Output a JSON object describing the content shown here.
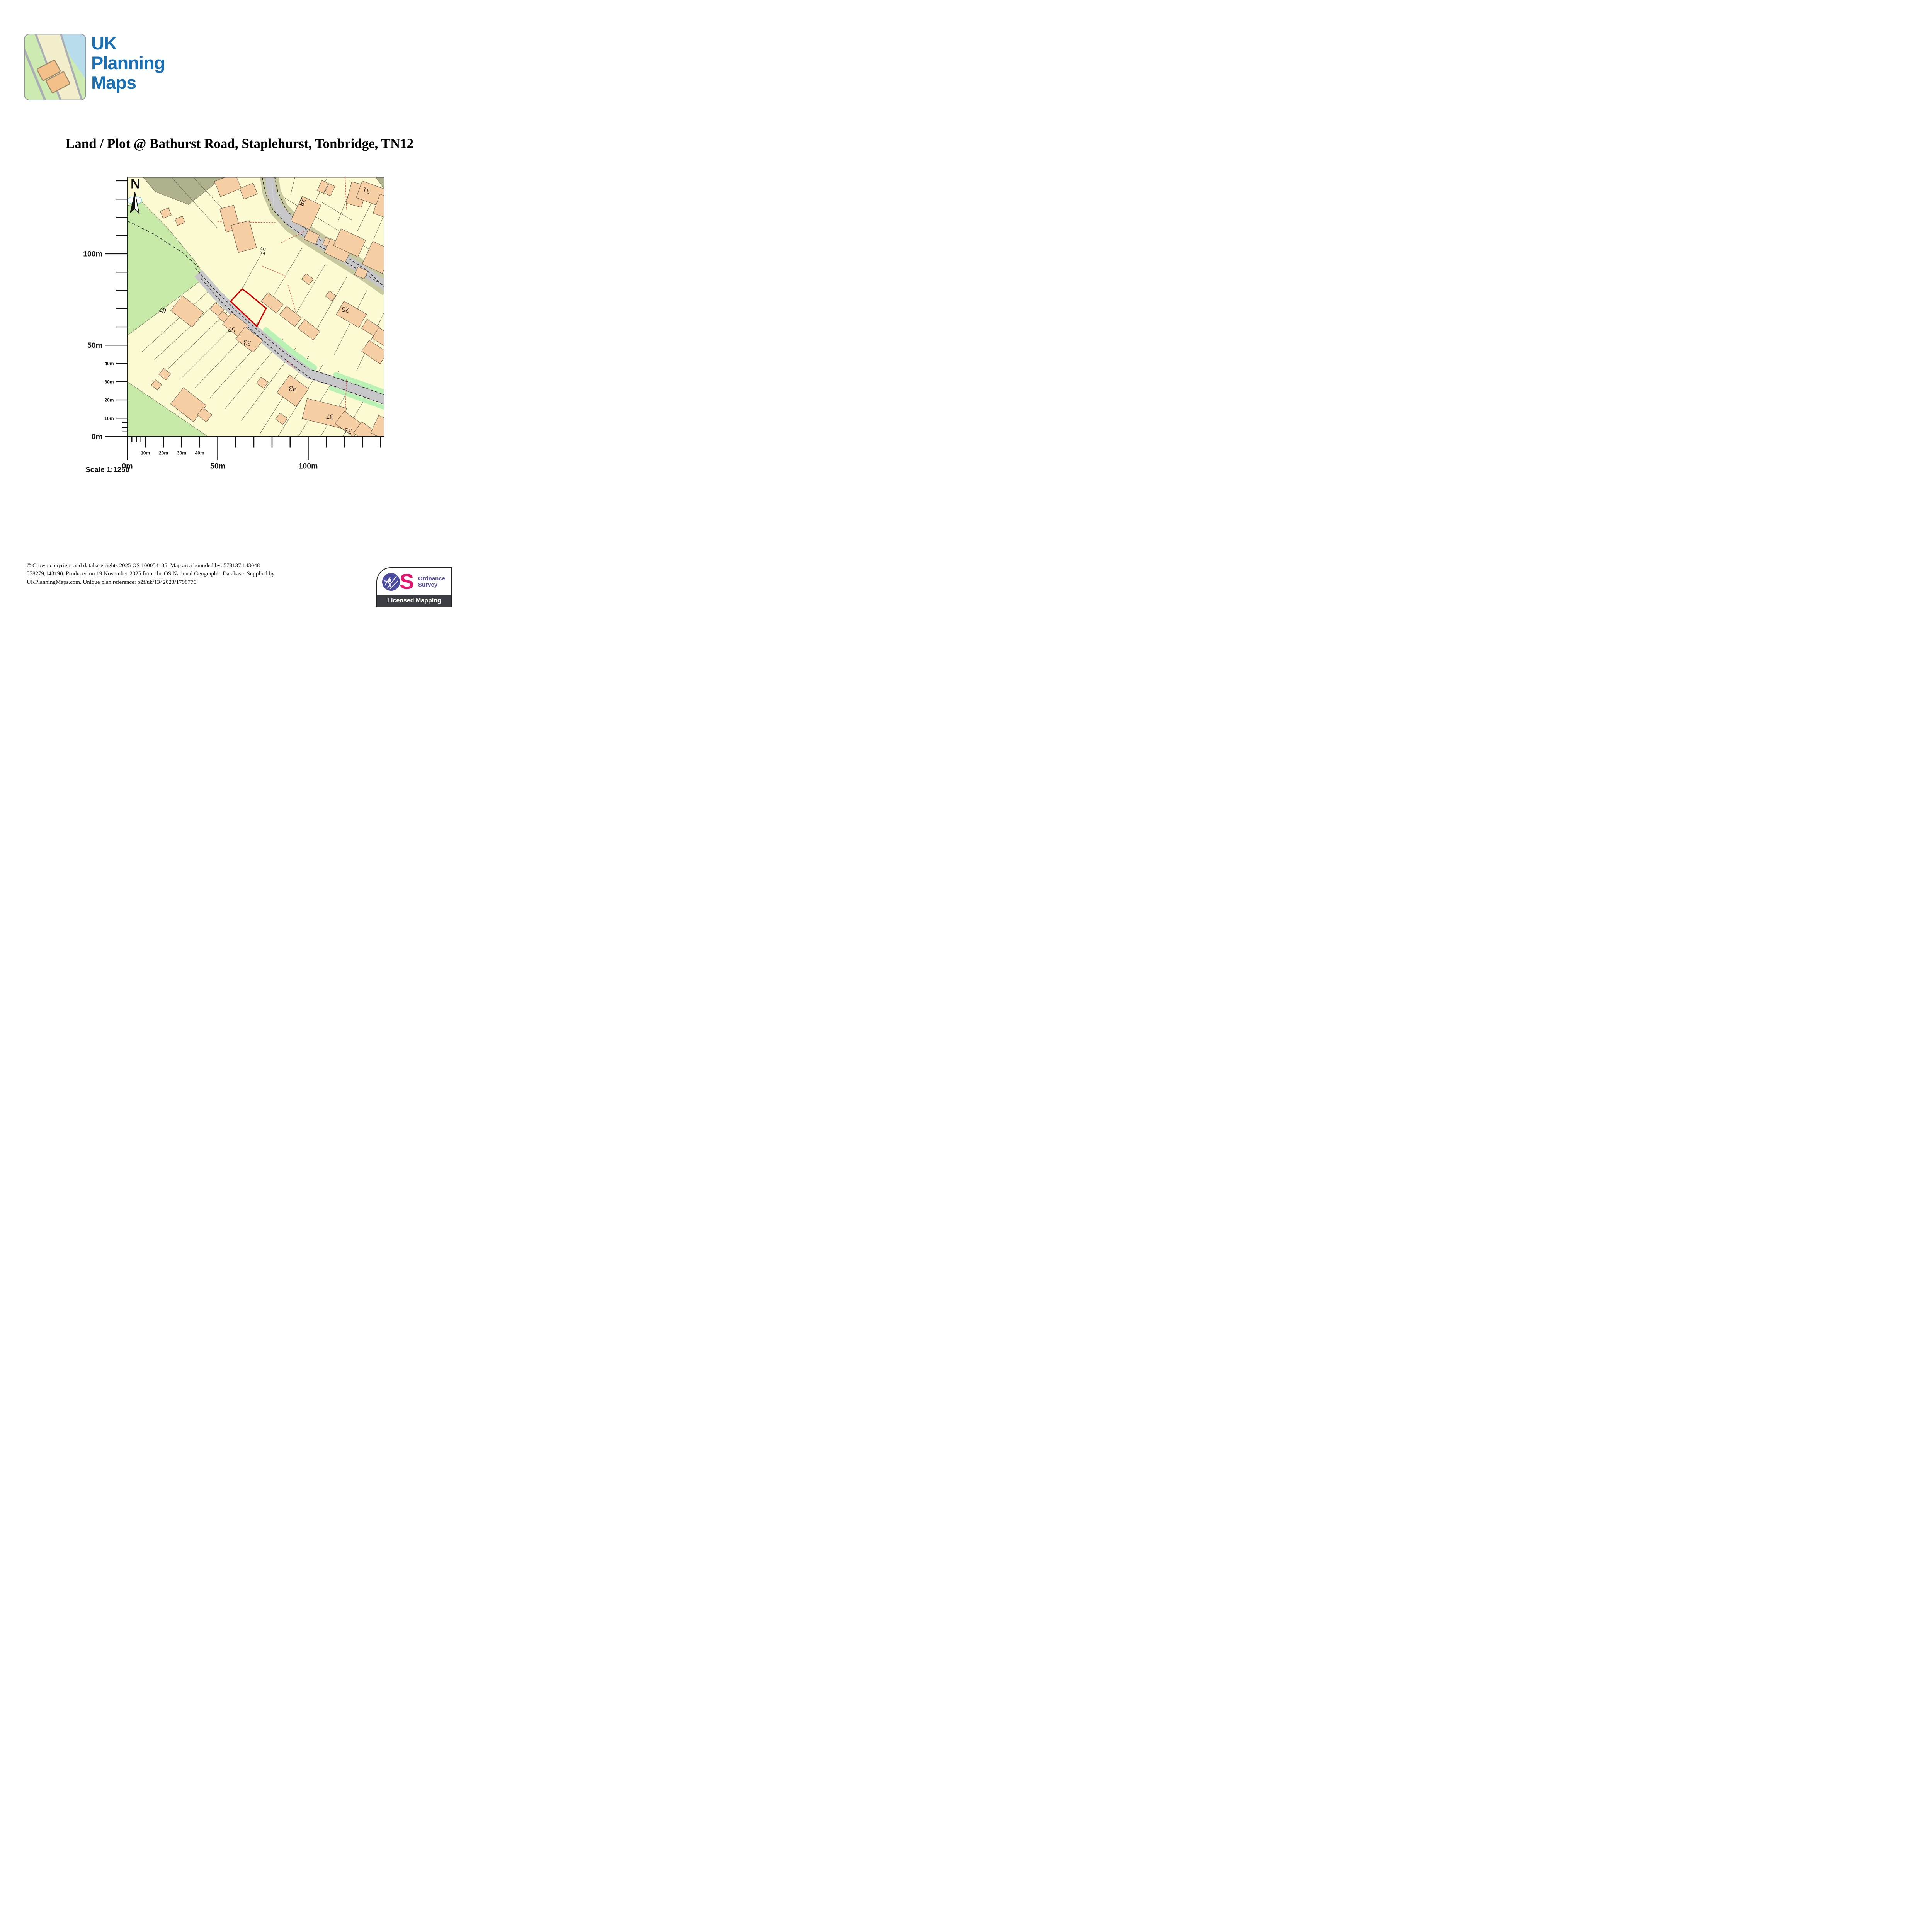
{
  "logo": {
    "brand": [
      "UK",
      "Planning",
      "Maps"
    ]
  },
  "title": "Land / Plot @ Bathurst Road, Staplehurst, Tonbridge, TN12",
  "map": {
    "north": "N",
    "house_numbers": [
      "31",
      "28",
      "37",
      "25",
      "67",
      "57",
      "53",
      "43",
      "37",
      "33"
    ],
    "scale_label": "Scale 1:1250"
  },
  "axes": {
    "vertical": [
      "0m",
      "10m",
      "20m",
      "30m",
      "40m",
      "50m",
      "100m"
    ],
    "horizontal": [
      "0m",
      "10m",
      "20m",
      "30m",
      "40m",
      "50m",
      "100m"
    ]
  },
  "footer": {
    "lines": [
      "© Crown copyright and database rights 2025 OS 100054135. Map area bounded by: 578137,143048",
      "578279,143190. Produced on 19 November 2025 from the OS National Geographic Database. Supplied by",
      "UKPlanningMaps.com. Unique plan reference: p2f/uk/1342023/1798776"
    ]
  },
  "badge": {
    "org": [
      "Ordnance",
      "Survey"
    ],
    "s_glyph": "S",
    "tagline": "Licensed Mapping"
  },
  "colors": {
    "plot_outline": "#d40000",
    "road_gray": "#c7c6c9",
    "verge_olive": "#c8c9a1",
    "field_green": "#c7eaa8",
    "verge_green": "#b9f2b4",
    "building_orange": "#f6cfa4",
    "map_background": "#fcfad2",
    "brand_blue": "#1a70b4",
    "os_purple": "#4a4a9e",
    "os_pink": "#e3156e"
  }
}
